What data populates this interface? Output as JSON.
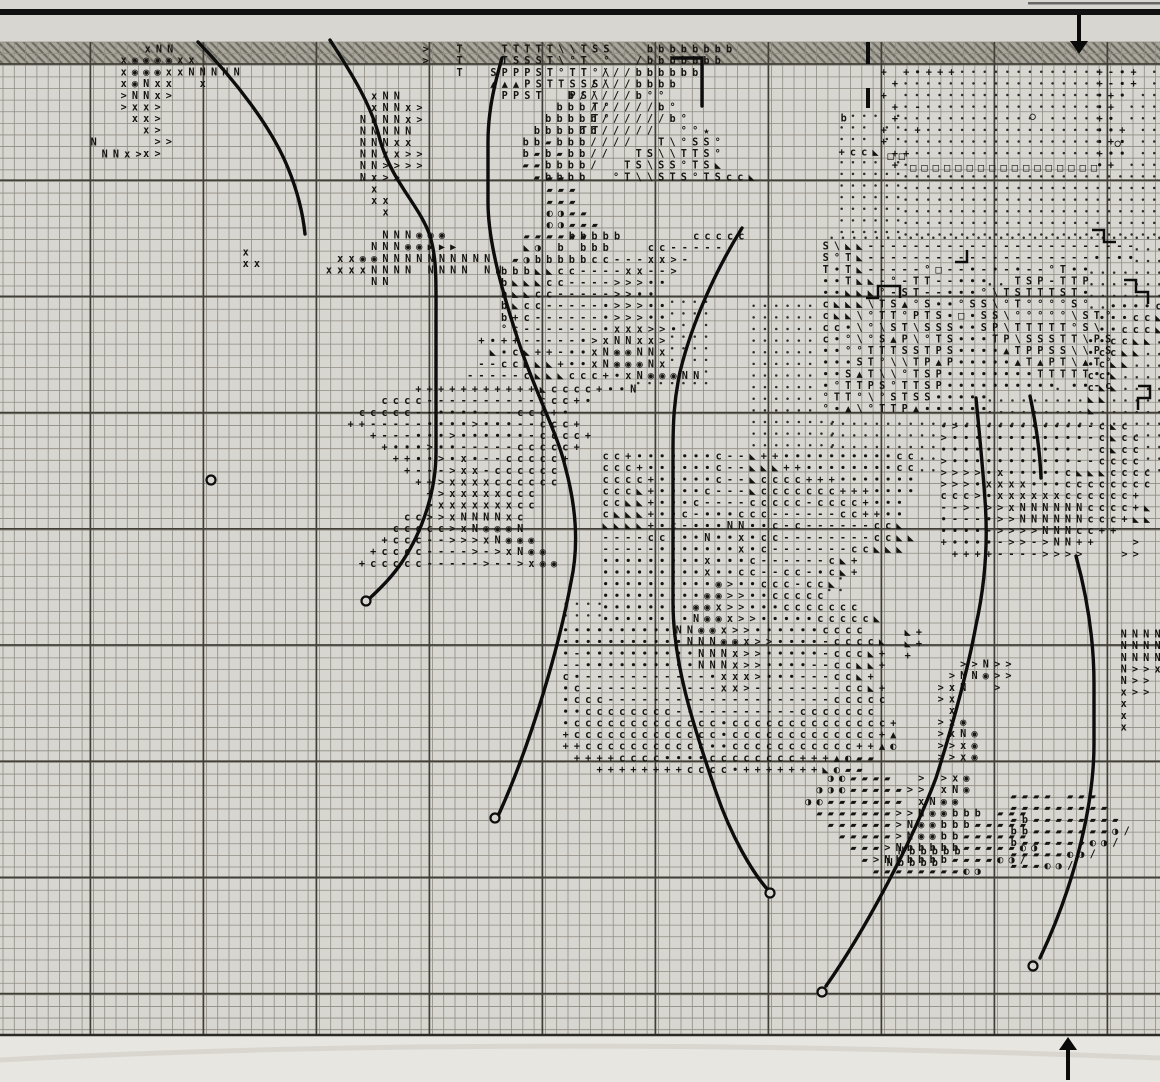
{
  "document": {
    "kind": "cross-stitch pattern chart page",
    "symbols_used": [
      "x",
      "N",
      ">",
      "T",
      "S",
      "P",
      "b",
      "c",
      "+",
      "-",
      "·",
      "°",
      "□",
      "○",
      "★",
      "▲",
      "▶",
      "◣",
      "◉",
      "◐",
      "◑",
      "▰",
      "/",
      "\\"
    ]
  },
  "palette": {
    "paper": "#d8d6d0",
    "paper_below": "#e8e6e1",
    "band_fill": "#a9a69c",
    "band_hatch": "#6e6c62",
    "grid_minor": "#8f8c83",
    "grid_major": "#413e37",
    "ink": "#151310",
    "stitch_black": "#0d0d0d"
  },
  "grid": {
    "x0": 3,
    "y0": 42,
    "cellw": 11.3,
    "cellh": 11.62,
    "cols": 102,
    "rows": 85,
    "major_every": 10,
    "major_x_start": 90.4,
    "major_x_step": 113,
    "major_y_start": 64,
    "major_y_step": 116.2,
    "bottom_edge_y": 1035
  },
  "band": {
    "x": 0,
    "y": 42,
    "w": 1160,
    "h": 22
  },
  "top_rule": {
    "x": 0,
    "y": 9,
    "w": 1160,
    "h": 6
  },
  "corner_edge": {
    "x": 1028,
    "y": 2,
    "w": 132,
    "h": 2.5
  },
  "center_marks": [
    [
      868,
      42,
      868,
      64
    ],
    [
      868,
      88,
      868,
      108
    ]
  ],
  "arrows": {
    "down": {
      "x": 1079,
      "shaft_top": 15,
      "tip_y": 54,
      "half_w": 9,
      "head_h": 13
    },
    "up": {
      "x": 1068,
      "tip_y": 1037,
      "base_y": 1080,
      "half_w": 9,
      "head_h": 13
    }
  },
  "knots": [
    [
      211,
      480
    ],
    [
      366,
      601
    ],
    [
      495,
      818
    ],
    [
      770,
      893
    ],
    [
      822,
      992
    ],
    [
      1033,
      966
    ]
  ],
  "backstitch": [
    "M198,42 C235,80 272,128 288,168 C297,190 303,214 305,234",
    "M330,40 C352,74 372,106 380,140 C392,182 420,206 430,236 C437,259 436,282 436,322 L436,452 C436,492 422,532 402,562 C390,580 376,592 368,600",
    "M502,58 C494,86 488,112 488,142 L488,202 C488,242 502,292 522,352 C540,402 558,436 565,466 C576,506 579,546 571,582 C560,642 532,742 498,816",
    "M742,228 C716,270 692,322 680,372 C674,400 673,422 673,452 L673,602 C673,662 692,722 716,792 C731,836 752,872 768,890",
    "M976,398 C980,440 983,470 985,500 C988,540 986,580 976,625 C966,680 948,740 936,778 C912,842 864,932 826,986",
    "M1076,556 C1088,600 1094,642 1094,684 L1094,744 C1094,802 1076,882 1040,958",
    "M673,58 L702,58 L702,106",
    "M1030,396 C1036,424 1040,452 1041,478"
  ],
  "backstitch_steps": [
    "M866,298 L878,298 L878,286 L900,286 L900,298",
    "M1092,230 L1104,230 L1104,242 L1116,242",
    "M1124,280 L1136,280 L1136,292 L1148,292 L1148,304",
    "M1138,386 L1150,386 L1150,398 L1138,398 L1138,410",
    "M955,262 L967,262 L967,250"
  ],
  "dotfields": [
    {
      "x": 900,
      "y": 66,
      "w": 256,
      "h": 164
    },
    {
      "x": 836,
      "y": 110,
      "w": 64,
      "h": 120
    },
    {
      "x": 826,
      "y": 232,
      "w": 330,
      "h": 236
    },
    {
      "x": 610,
      "y": 296,
      "w": 100,
      "h": 88
    },
    {
      "x": 688,
      "y": 468,
      "w": 150,
      "h": 160
    },
    {
      "x": 938,
      "y": 420,
      "w": 120,
      "h": 104
    },
    {
      "x": 560,
      "y": 598,
      "w": 132,
      "h": 94
    },
    {
      "x": 748,
      "y": 300,
      "w": 80,
      "h": 152
    }
  ],
  "clusters": [
    {
      "x": 118,
      "y": 54,
      "rows": [
        "x◉◉◉◉xx"
      ]
    },
    {
      "x": 142,
      "y": 43,
      "rows": [
        "xNN"
      ]
    },
    {
      "x": 118,
      "y": 66,
      "rows": [
        "x◉◉◉xxNNNNN",
        "x◉Nxx  x",
        ">NNx>",
        ">xx>",
        " xx>",
        "  x>",
        "   >>",
        "  x>"
      ]
    },
    {
      "x": 88,
      "y": 136,
      "rows": [
        "N"
      ]
    },
    {
      "x": 99,
      "y": 148,
      "rows": [
        "NNx>"
      ]
    },
    {
      "x": 346,
      "y": 90,
      "rows": [
        "  xNN",
        "  xNNx>",
        " NNNNx>",
        " NNNNN",
        " NNNxx",
        " NNxx>>",
        " NN>>>>",
        " Nx>>",
        "  x",
        "  xx",
        "   x"
      ]
    },
    {
      "x": 312,
      "y": 229,
      "rows": [
        "      NNN◉◉◉",
        "     NNN◉◉▶▶▶",
        "  xx◉◉NNNNNNNNNN",
        " xxxxNNNN NNNN NN",
        "     NN"
      ]
    },
    {
      "x": 240,
      "y": 246,
      "rows": [
        "x",
        "xx"
      ]
    },
    {
      "x": 420,
      "y": 43,
      "rows": [
        ">  T   TTTTT\\\\TSS",
        ">  T   TSSST\\°T °",
        "   T  SPPPST°TT°\\",
        "      ▲▲▲PSTTSSS\\",
        "       PPST  PS\\",
        "               T°",
        "               T°",
        "              TT"
      ]
    },
    {
      "x": 520,
      "y": 43,
      "rows": [
        "           bbbbbbbb",
        "          /bbbbbbb",
        "       ///bbbbbb",
        "      ////bbbb",
        "    b/////b°°",
        "   bbb//////b°",
        "  bbbbb//////b°",
        " bbbbbb/////  °°★",
        "bb▰bbb////  T\\°SS°",
        "b▰b▰bb//  TS\\\\TTS°",
        "▰▰bbbb/  TS\\SS°TS◣",
        " ▰bbbb  °T\\\\STS°TScc◣"
      ]
    },
    {
      "x": 544,
      "y": 172,
      "rows": [
        "▰▰",
        "▰▰▰",
        "▰▰▰",
        "◐◑▰▰",
        "◐◑▰▰▰",
        "▰▰▰▰"
      ]
    },
    {
      "x": 408,
      "y": 230,
      "rows": [
        "          ▰▰▰ bbbbb      ccccc",
        "          ◣◑ b bbb   cc------",
        "         ▰◑bbbbbcc---xx>-",
        "        bbb◣◣cc----xx-->",
        "        b◣◣◣cc---->>>··",
        "        b◣◣cc----->>··",
        "        b◣cc-----·>>>··",
        "        b+c------·>>>··",
        "        °c-------·xxx>>·",
        "      +·++-----·>xNNxx>",
        "       ◣·c◣++-··xN◉◉NNx",
        "      --cc◣◣◣+··xN◉◉◉Nx",
        "     -----c◣◣◣ccc+·xN◉◉◉NN"
      ]
    },
    {
      "x": 345,
      "y": 383,
      "rows": [
        "      +++++++++++◣cccc+··N",
        "   cccc----------ccc+·",
        " ccccc--····---ccc+·",
        "++-----····>···--ccc+",
        "  +---···>······-cccc+",
        "   +···>··-----ccccc+",
        "    ++··>·x·--ccccc+",
        "     +--->xx-cccccc",
        "      ++>xxxxcccccc",
        "       +>xxxxxccc",
        "       >xxxxxxxcc",
        "     cc>>xNNNNxc",
        "    ccccc>xN◉◉◉N",
        "   +ccc-->>>xN◉◉◉",
        "  +cccc---->->xN◉◉",
        " +ccccc----->-->x◉◉"
      ]
    },
    {
      "x": 600,
      "y": 450,
      "rows": [
        "cc+·······c--◣++··········cc",
        "ccc+······c--◣◣◣++········cc",
        "cccc+·····c--◣cccc+++·······",
        "ccc◣+····c---◣ccccccc+++····",
        "cc◣◣+···c----ccccc-cccc+···",
        "c◣◣◣+··c-···ccc------cc++··",
        "◣◣◣◣+·c-···NN··c-c------cc◣",
        "----cc-··N··x·cc--------cc◣◣",
        "-----·······x·c-------cc◣◣◣",
        "·········x···c------c◣+",
        "·········x··cc--cc-·c◣+",
        "··········◉>··ccc-cc◣",
        "·········◉◉>>··ccccc",
        "········◉◉x>>···ccccccc",
        "········N◉◉x>>·····ccccc◣"
      ]
    },
    {
      "x": 560,
      "y": 624,
      "rows": [
        "··········NN◉◉x>>······cccc",
        "···········NNN◉◉x>>····-cccc◣",
        "·-··········NNNx>>·····-ccc◣+",
        "--··········NNNx>>····--cc◣◣+",
        "c·-----------·xxx>···---cc◣+",
        "·c------------xx>--------cc◣+",
        "·ccc--------------------ccccc",
        "··cccccccc-----------ccccccc",
        "·ccccccccccccc·cccccccccccccc+",
        "+ccccccccccccc·ccccccccccccc+▲",
        "++ccccccccccc··ccccccccccc++▲◐",
        " ++++cccc····cccccccc+++▲◐▰▰",
        "   ++++++++cccc·+++++++◣◐▰▰"
      ]
    },
    {
      "x": 780,
      "y": 772,
      "rows": [
        "    ◑◐▰▰▰▰  > >x◉",
        "   ◑◑◐▰▰▰▰▰>> xN◉",
        "  ◑◐▰▰▰▰▰▰▰ xN◉◉",
        "   ▰▰▰▰▰▰▰>>N◉◉bbb ▰▰▰",
        "    ▰▰▰▰▰▰>N◉◉bbb▰▰▰▰▰",
        "     ▰▰▰▰▰>N◉◉bb▰▰▰▰▰▰",
        "      ▰▰▰>Nbbbbb▰▰▰▰▰◐◑",
        "       ▰>Nbbbbb▰▰▰▰◐◑/",
        "        ▰▰▰▰▰▰▰▰◐◑"
      ]
    },
    {
      "x": 1008,
      "y": 790,
      "rows": [
        "▰▰▰▰ ▰▰▰",
        "▰▰▰▰▰▰▰▰▰",
        "▰b▰▰▰▰▰▰▰▰",
        "bb▰▰▰▰▰▰▰◑/",
        "b▰▰▰▰▰▰◐◑/",
        "▰▰▰▰▰◐◑/",
        "▰▰▰◐◑/"
      ]
    },
    {
      "x": 884,
      "y": 845,
      "rows": [
        " Nbbbbb",
        "Nbbbb"
      ]
    },
    {
      "x": 935,
      "y": 658,
      "rows": [
        "  >>N>>",
        " >NN◉>>",
        ">xN  >",
        ">x",
        " x",
        ">x◉",
        ">xN◉",
        ">>x◉",
        ">>x◉"
      ]
    },
    {
      "x": 902,
      "y": 626,
      "rows": [
        "◣+",
        "◣+",
        "+"
      ]
    },
    {
      "x": 1118,
      "y": 628,
      "rows": [
        "NNNN",
        "NNNNN",
        "NNNN",
        "N>>x>",
        "N>>",
        "x>>",
        "x",
        "x",
        "x"
      ]
    },
    {
      "x": 938,
      "y": 420,
      "rows": [
        "·>···········-c◣c",
        ">············-c◣cc",
        "············--c◣cc",
        ">···········--cccc",
        ">>>>·x·····c◣◣◣cccc",
        ">>>·xxxx···cccccccc",
        "ccc>·xxxxxxcccccc+",
        "-->->>xNNNNNNcccc+◣",
        "·---·>>NNNNNNccc+◣◣",
        "····->>>>NNNcc++",
        "+····->>->NN++   >",
        " ++++---->>>>   >>"
      ]
    },
    {
      "x": 1085,
      "y": 300,
      "rows": [
        "  ····c◣",
        " ···cc◣◣",
        " ··ccc◣",
        "··cc◣◣",
        "·cc◣◣",
        "·c◣◣",
        "cc◣",
        "c◣◣",
        "◣◣",
        "◣"
      ]
    },
    {
      "x": 820,
      "y": 240,
      "rows": [
        "S\\◣◣------------------------",
        "S°T◣--------------------·-··",
        "T·T◣-----°□--·-·-·--°T··",
        "··T◣◣-°-TT--···  TSP-TTP",
        "··◣◣◣°-ST--···°\\TSTTTST·",
        "c◣◣◣\\TS▲°S··°SS\\°T°°°°S°",
        "c◣◣\\°TT°PTS·□·SS\\°°°°°\\ST°",
        "cc·\\°\\ST\\SSS··SP\\TTTTT°S\\",
        "c·°\\°S▲P\\°TS···TP\\SSSTT\\PS",
        "··°°TTTSSTPS····▲TPPSS\\\\PS",
        "···ST°\\\\TP▲P·····▲T▲PT\\▲T°",
        "··S▲T\\\\°TSP········TTTTT··",
        "·°TTPS°TTSP·········· ··-c",
        "°TT°\\°STSS·····",
        "°·▲\\°TTP▲······"
      ]
    },
    {
      "x": 878,
      "y": 66,
      "rows": [
        "+ +·+++",
        " +",
        "+",
        " + -",
        " +",
        "+  +",
        "+",
        " ++",
        " +"
      ]
    },
    {
      "x": 1094,
      "y": 66,
      "rows": [
        "+-·+",
        "+-·+",
        "·+·",
        "·+",
        "+·",
        "··+",
        "·+·",
        "+··",
        "·+"
      ]
    },
    {
      "x": 885,
      "y": 150,
      "rows": [
        "□□",
        "  □□□□□□□□□□□□□□□□□"
      ]
    },
    {
      "x": 1027,
      "y": 110,
      "rows": [
        "○"
      ]
    },
    {
      "x": 1112,
      "y": 137,
      "rows": [
        "○"
      ]
    },
    {
      "x": 838,
      "y": 112,
      "rows": [
        "b"
      ]
    },
    {
      "x": 836,
      "y": 146,
      "rows": [
        "+cc◣"
      ]
    }
  ]
}
